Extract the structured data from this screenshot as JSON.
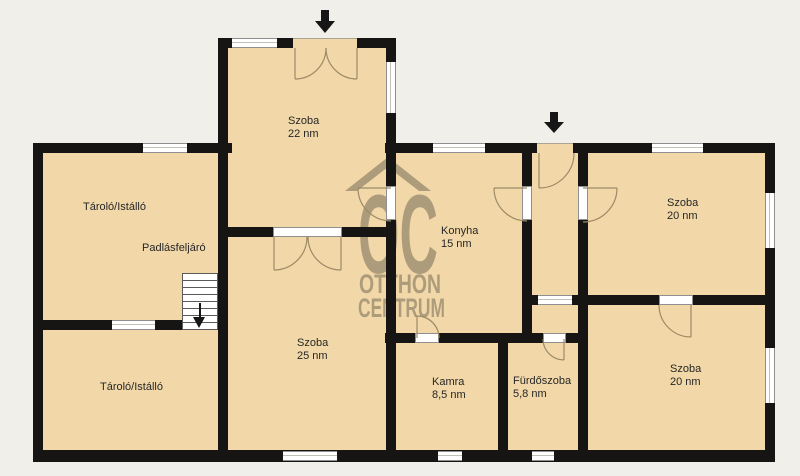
{
  "plan": {
    "rooms": [
      {
        "name": "Szoba",
        "area": "22 nm"
      },
      {
        "name": "Tároló/Istálló",
        "area": ""
      },
      {
        "name": "Padlásfeljáró",
        "area": ""
      },
      {
        "name": "Tároló/Istálló",
        "area": ""
      },
      {
        "name": "Szoba",
        "area": "25 nm"
      },
      {
        "name": "Konyha",
        "area": "15 nm"
      },
      {
        "name": "Szoba",
        "area": "20 nm"
      },
      {
        "name": "Kamra",
        "area": "8,5 nm"
      },
      {
        "name": "Fürdőszoba",
        "area": "5,8 nm"
      },
      {
        "name": "Szoba",
        "area": "20 nm"
      }
    ],
    "watermark": {
      "logo": "OC",
      "line1": "OTTHON",
      "line2": "CENTRUM"
    },
    "icons": {
      "entrance_arrow": "▼",
      "stairs_down_arrow": "▼"
    },
    "colors": {
      "room_fill": "#f2d8a8",
      "wall": "#171513",
      "background": "#f1efea",
      "watermark": "#6b6152"
    }
  }
}
